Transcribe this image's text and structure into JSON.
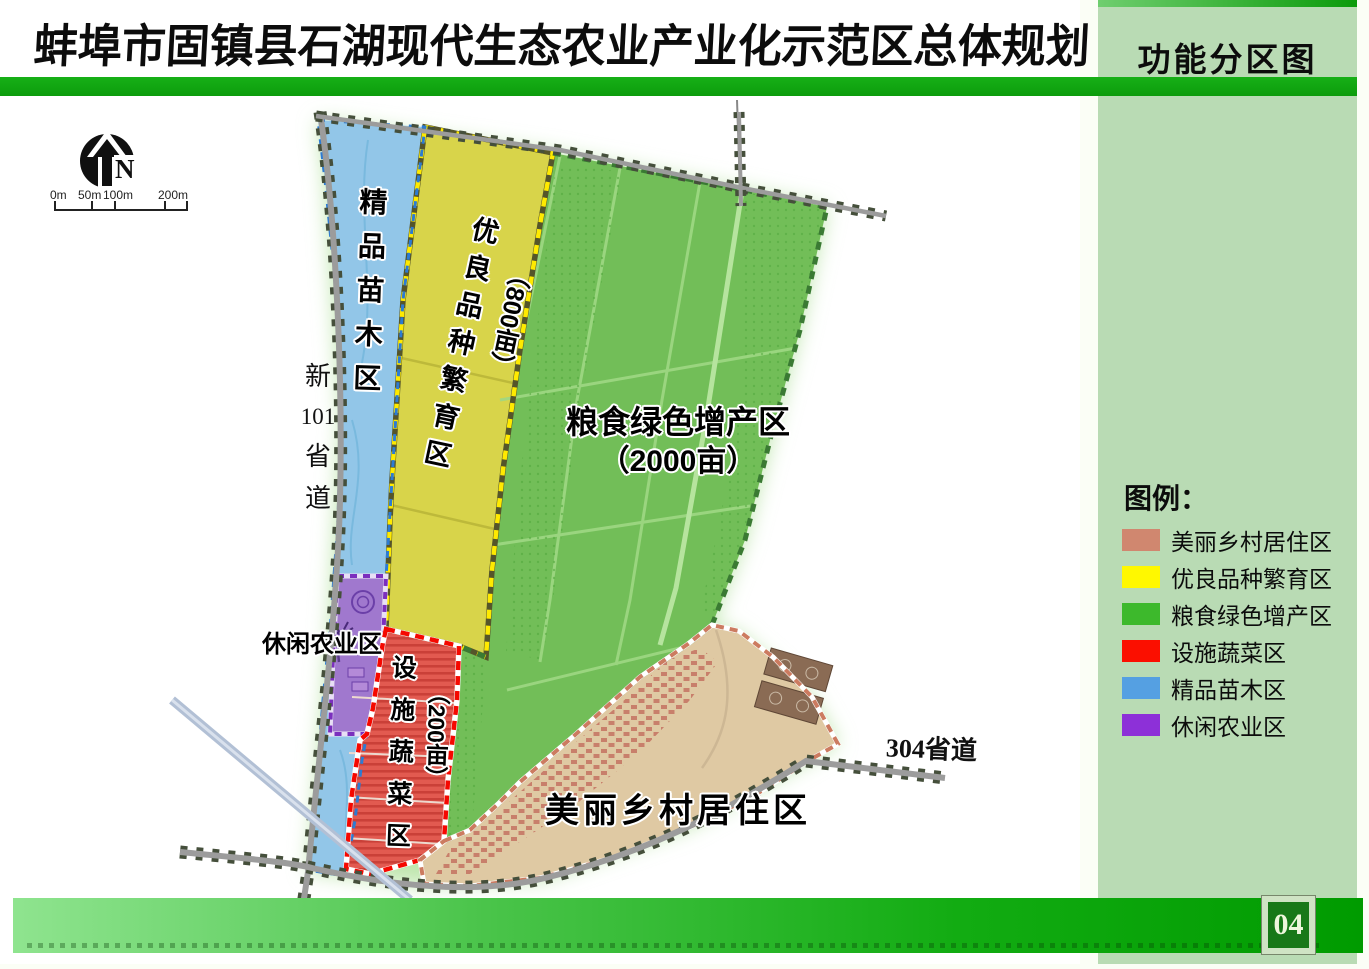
{
  "header": {
    "title": "蚌埠市固镇县石湖现代生态农业产业化示范区总体规划",
    "tab": "功能分区图"
  },
  "map": {
    "compass": "N",
    "scale_labels": [
      "0m",
      "50m",
      "100m",
      "200m"
    ],
    "zones": {
      "nursery": {
        "label": "精品苗木区"
      },
      "seed": {
        "label": "优良品种繁育区",
        "area": "（800亩）"
      },
      "grain": {
        "label": "粮食绿色增产区",
        "area": "（2000亩）"
      },
      "vegetable": {
        "label": "设施蔬菜区",
        "area": "（200亩）"
      },
      "leisure": {
        "label": "休闲农业区"
      },
      "village": {
        "label": "美丽乡村居住区"
      }
    },
    "roads": {
      "left_parts": [
        "新",
        "101",
        "省",
        "道"
      ],
      "right": "304省道"
    }
  },
  "legend": {
    "title": "图例：",
    "items": [
      {
        "label": "美丽乡村居住区",
        "color": "#D0876F"
      },
      {
        "label": "优良品种繁育区",
        "color": "#FFF800"
      },
      {
        "label": "粮食绿色增产区",
        "color": "#3DB92C"
      },
      {
        "label": "设施蔬菜区",
        "color": "#FB0F00"
      },
      {
        "label": "精品苗木区",
        "color": "#55A0E2"
      },
      {
        "label": "休闲农业区",
        "color": "#8D30D8"
      }
    ]
  },
  "footer": {
    "page": "04"
  }
}
